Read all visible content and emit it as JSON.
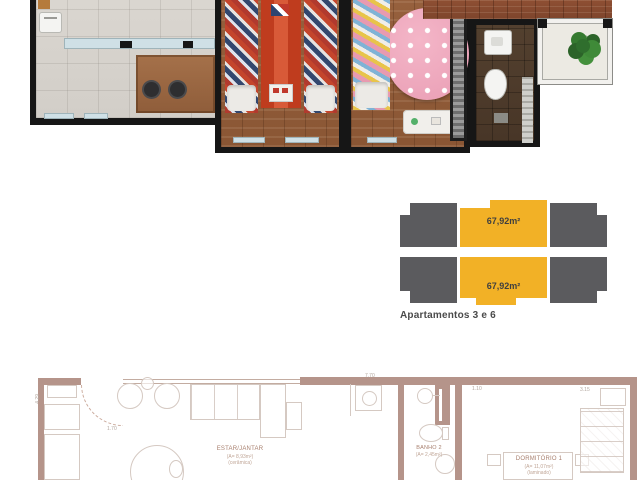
{
  "colors": {
    "keyplan_highlight": "#F2B126",
    "keyplan_block": "#5B5B5E",
    "plan_wall_tan": "#B5948A",
    "render_wall_black": "#161616"
  },
  "key_plan": {
    "caption": "Apartamentos 3 e 6",
    "units": [
      {
        "area_label": "67,92m²"
      },
      {
        "area_label": "67,92m²"
      }
    ]
  },
  "floor_plan": {
    "rooms": {
      "estar": {
        "name": "ESTAR/JANTAR",
        "line2": "(A= 8,93m²)",
        "line3": "(cerâmica)"
      },
      "banho": {
        "name": "BANHO 2",
        "line2": "(A= 2,45m²)"
      },
      "dorm": {
        "name": "DORMITÓRIO 1",
        "line2": "(A= 11,07m²)",
        "line3": "(laminado)"
      }
    },
    "dims": {
      "top": "7.70",
      "entry": "1.70",
      "left": "4.29",
      "banho_top": "1.10",
      "dorm_top": "3.15"
    }
  }
}
